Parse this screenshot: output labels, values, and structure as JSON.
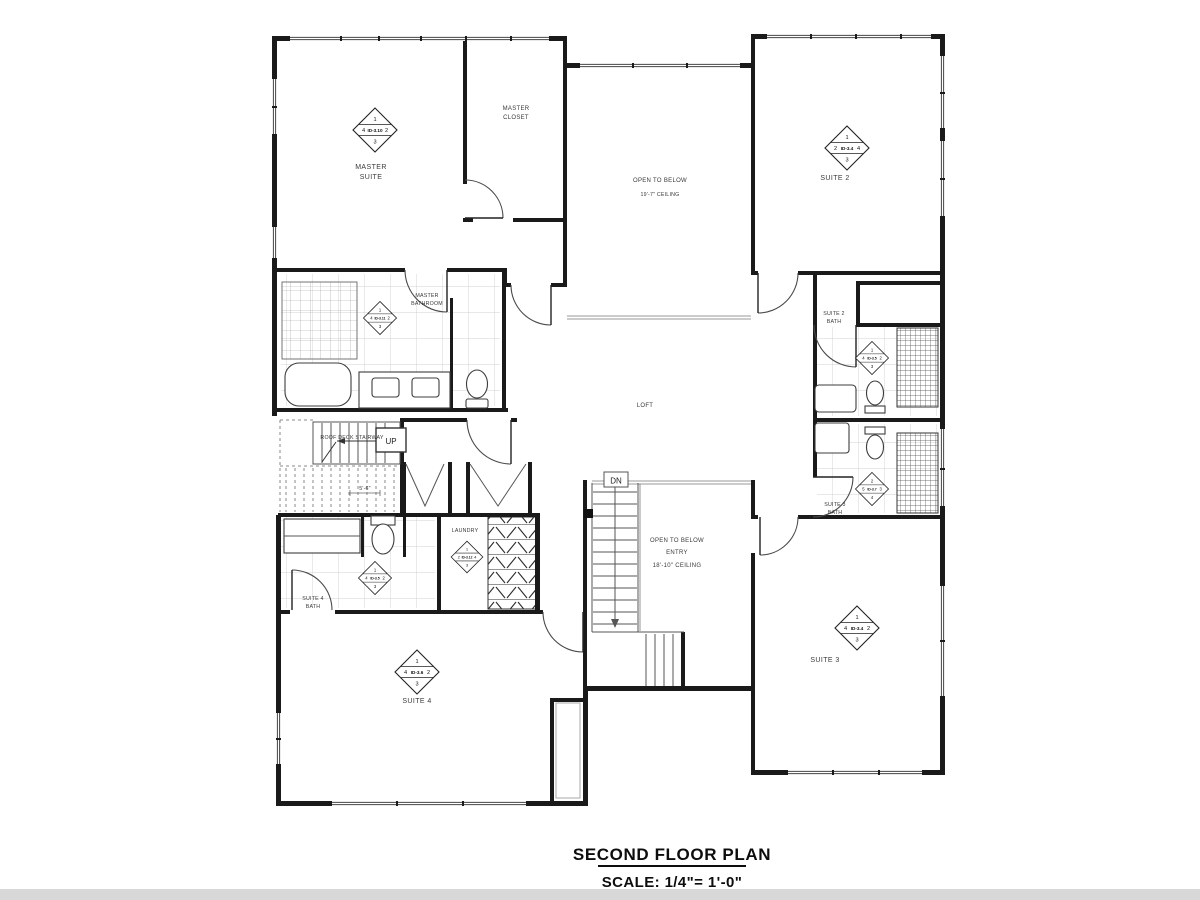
{
  "title_block": {
    "title": "SECOND FLOOR PLAN",
    "scale": "SCALE: 1/4\"= 1'-0\""
  },
  "rooms": {
    "master_suite": {
      "line1": "MASTER",
      "line2": "SUITE"
    },
    "master_closet": {
      "line1": "MASTER",
      "line2": "CLOSET"
    },
    "open_to_below": {
      "line1": "OPEN TO BELOW",
      "line2": "19'-7\" CEILING"
    },
    "suite2": {
      "line1": "SUITE 2"
    },
    "master_bathroom": {
      "line1": "MASTER",
      "line2": "BATHROOM"
    },
    "suite2_bath": {
      "line1": "SUITE 2",
      "line2": "BATH"
    },
    "loft": {
      "line1": "LOFT"
    },
    "suite3_bath": {
      "line1": "SUITE 3",
      "line2": "BATH"
    },
    "laundry": {
      "line1": "LAUNDRY"
    },
    "suite4_bath": {
      "line1": "SUITE 4",
      "line2": "BATH"
    },
    "entry": {
      "line1": "OPEN TO BELOW",
      "line2": "ENTRY",
      "line3": "18'-10\" CEILING"
    },
    "suite4": {
      "line1": "SUITE 4"
    },
    "suite3": {
      "line1": "SUITE 3"
    }
  },
  "annotations": {
    "roof_deck_stairway": "ROOF DECK STAIRWAY",
    "up": "UP",
    "dn": "DN",
    "stair_dimension": "5'-6\""
  },
  "tags": {
    "master_suite": {
      "id": "ID-3.10",
      "top": "1",
      "left": "4",
      "right": "2",
      "bottom": "3"
    },
    "master_bath": {
      "id": "ID-3.11",
      "top": "1",
      "left": "4",
      "right": "2",
      "bottom": "3"
    },
    "suite2": {
      "id": "ID-3.4",
      "top": "1",
      "left": "2",
      "right": "4",
      "bottom": "3"
    },
    "suite2_bath": {
      "id": "ID-3.5",
      "top": "1",
      "left": "4",
      "right": "2",
      "bottom": "3"
    },
    "suite3_bath": {
      "id": "ID-3.7",
      "top": "2",
      "left": "5",
      "right": "3",
      "bottom": "4"
    },
    "suite3": {
      "id": "ID-3.4",
      "top": "1",
      "left": "4",
      "right": "2",
      "bottom": "3"
    },
    "suite4": {
      "id": "ID-3.6",
      "top": "1",
      "left": "4",
      "right": "2",
      "bottom": "3"
    },
    "suite4_bath": {
      "id": "ID-3.5",
      "top": "1",
      "left": "4",
      "right": "2",
      "bottom": "3"
    },
    "laundry": {
      "id": "ID-3.12",
      "top": "1",
      "left": "2",
      "right": "4",
      "bottom": "3"
    }
  },
  "colors": {
    "wall": "#1a1a1a",
    "thin_line": "#555555",
    "tile_line": "#bdbdbd",
    "footer_strip": "#d8d8d8"
  }
}
